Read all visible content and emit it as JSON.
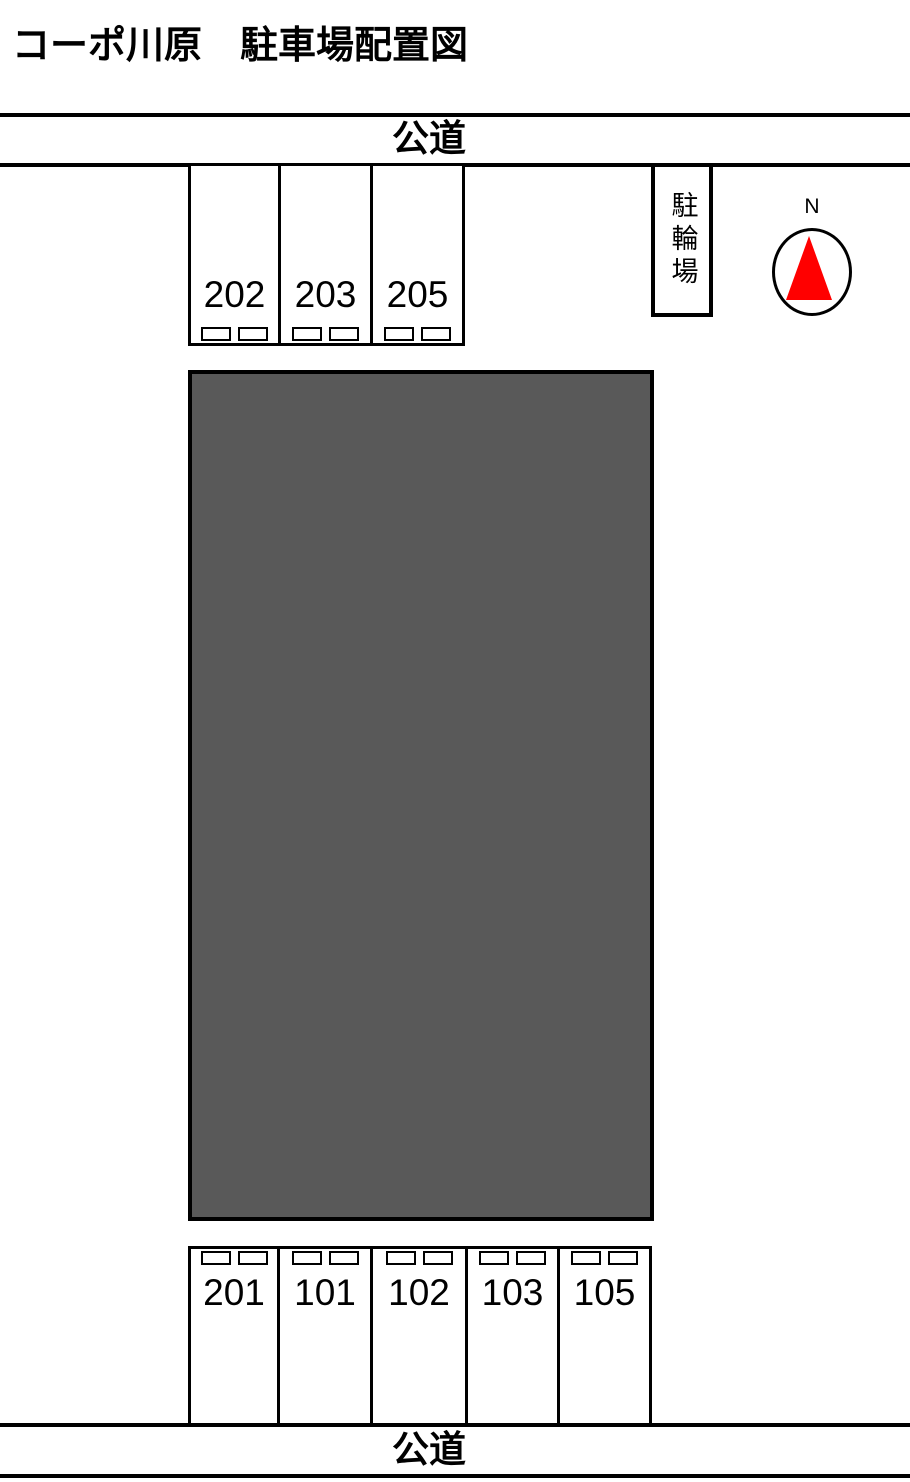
{
  "title": "コーポ川原　駐車場配置図",
  "top_road": {
    "label": "公道"
  },
  "bottom_road": {
    "label": "公道"
  },
  "top_spaces": [
    {
      "number": "202"
    },
    {
      "number": "203"
    },
    {
      "number": "205"
    }
  ],
  "bottom_spaces": [
    {
      "number": "201"
    },
    {
      "number": "101"
    },
    {
      "number": "102"
    },
    {
      "number": "103"
    },
    {
      "number": "105"
    }
  ],
  "bike_shed": {
    "label": "駐輪場"
  },
  "compass": {
    "label": "N",
    "arrow_color": "#ff0000"
  },
  "building": {
    "fill": "#595959"
  },
  "colors": {
    "line": "#000000",
    "background": "#ffffff"
  }
}
